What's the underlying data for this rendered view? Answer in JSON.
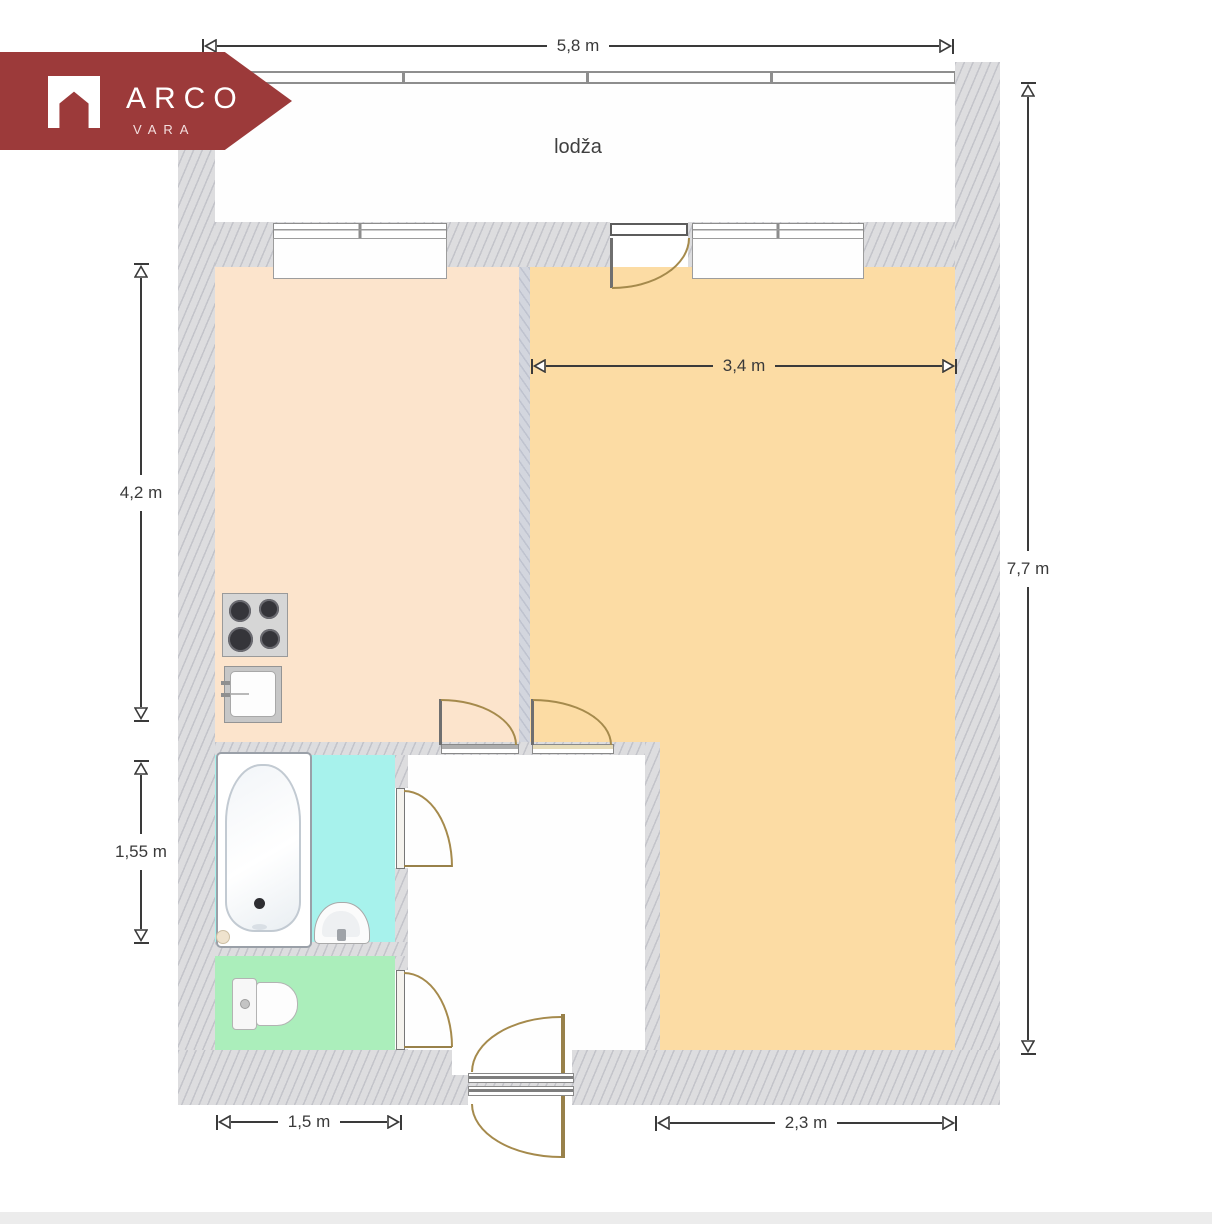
{
  "logo": {
    "title": "ARCO",
    "subtitle": "VARA",
    "brand_color": "#9c3a3a",
    "icon": "house-icon"
  },
  "floorplan": {
    "room_labels": {
      "loggia": "lodža"
    },
    "dimensions": {
      "loggia_width": "5,8 m",
      "living_width": "3,4 m",
      "kitchen_depth": "4,2 m",
      "bathroom_depth": "1,55 m",
      "apartment_depth": "7,7 m",
      "wc_width": "1,5 m",
      "living_bottom_width": "2,3 m"
    },
    "colors": {
      "wall": "#dddddf",
      "kitchen": "#fce4cc",
      "living_room": "#fcdca4",
      "bathroom": "#a7f2ec",
      "wc": "#abeebb",
      "door_arc": "#a58a4c",
      "dimension": "#3a3a3a"
    },
    "fixtures": [
      "stove",
      "kitchen-sink",
      "bathtub",
      "washbasin",
      "toilet"
    ],
    "doors": [
      "balcony-door",
      "kitchen-door",
      "living-room-door",
      "bathroom-door",
      "wc-door",
      "entrance-door"
    ],
    "windows": [
      "loggia-glazing",
      "kitchen-window",
      "living-room-window"
    ]
  }
}
